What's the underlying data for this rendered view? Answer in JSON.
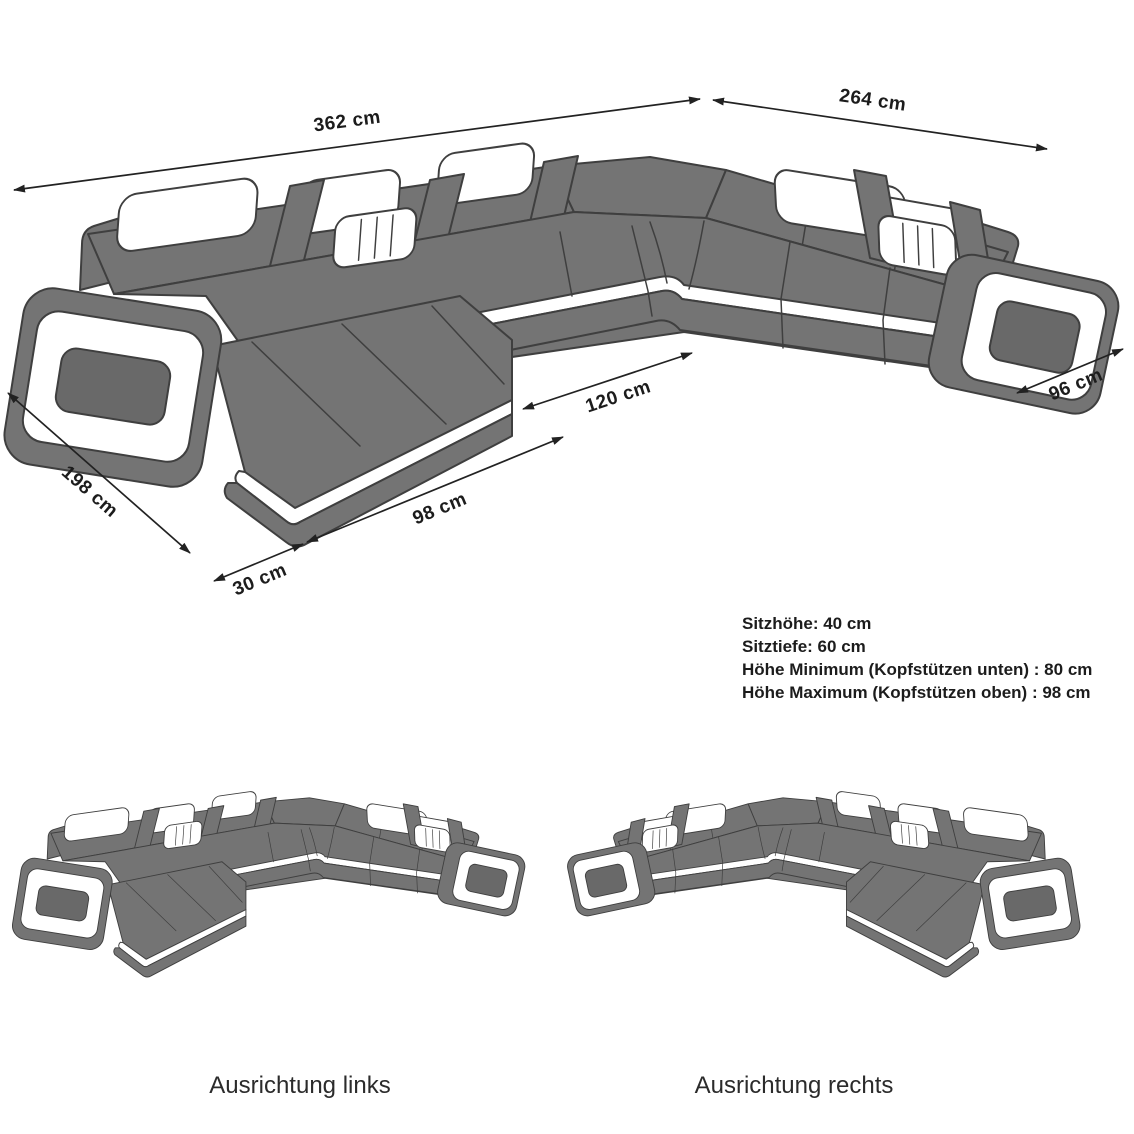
{
  "colors": {
    "sofa_gray": "#747474",
    "sofa_gray_dark": "#696969",
    "outline": "#3f3f3f",
    "accent": "#ffffff",
    "dimension": "#222222",
    "text": "#1c1c1c"
  },
  "main_diagram": {
    "dimensions": {
      "total_width": "362 cm",
      "right_section_width": "264 cm",
      "right_section_depth": "96 cm",
      "inner_opening": "120 cm",
      "chaise_width": "98 cm",
      "chaise_offset": "30 cm",
      "chaise_length": "198 cm"
    }
  },
  "specs": {
    "seat_height": "Sitzhöhe: 40 cm",
    "seat_depth": "Sitztiefe: 60 cm",
    "height_min": "Höhe Minimum (Kopfstützen unten) : 80 cm",
    "height_max": "Höhe Maximum (Kopfstützen oben) : 98 cm"
  },
  "variants": {
    "left_label": "Ausrichtung links",
    "right_label": "Ausrichtung rechts"
  }
}
